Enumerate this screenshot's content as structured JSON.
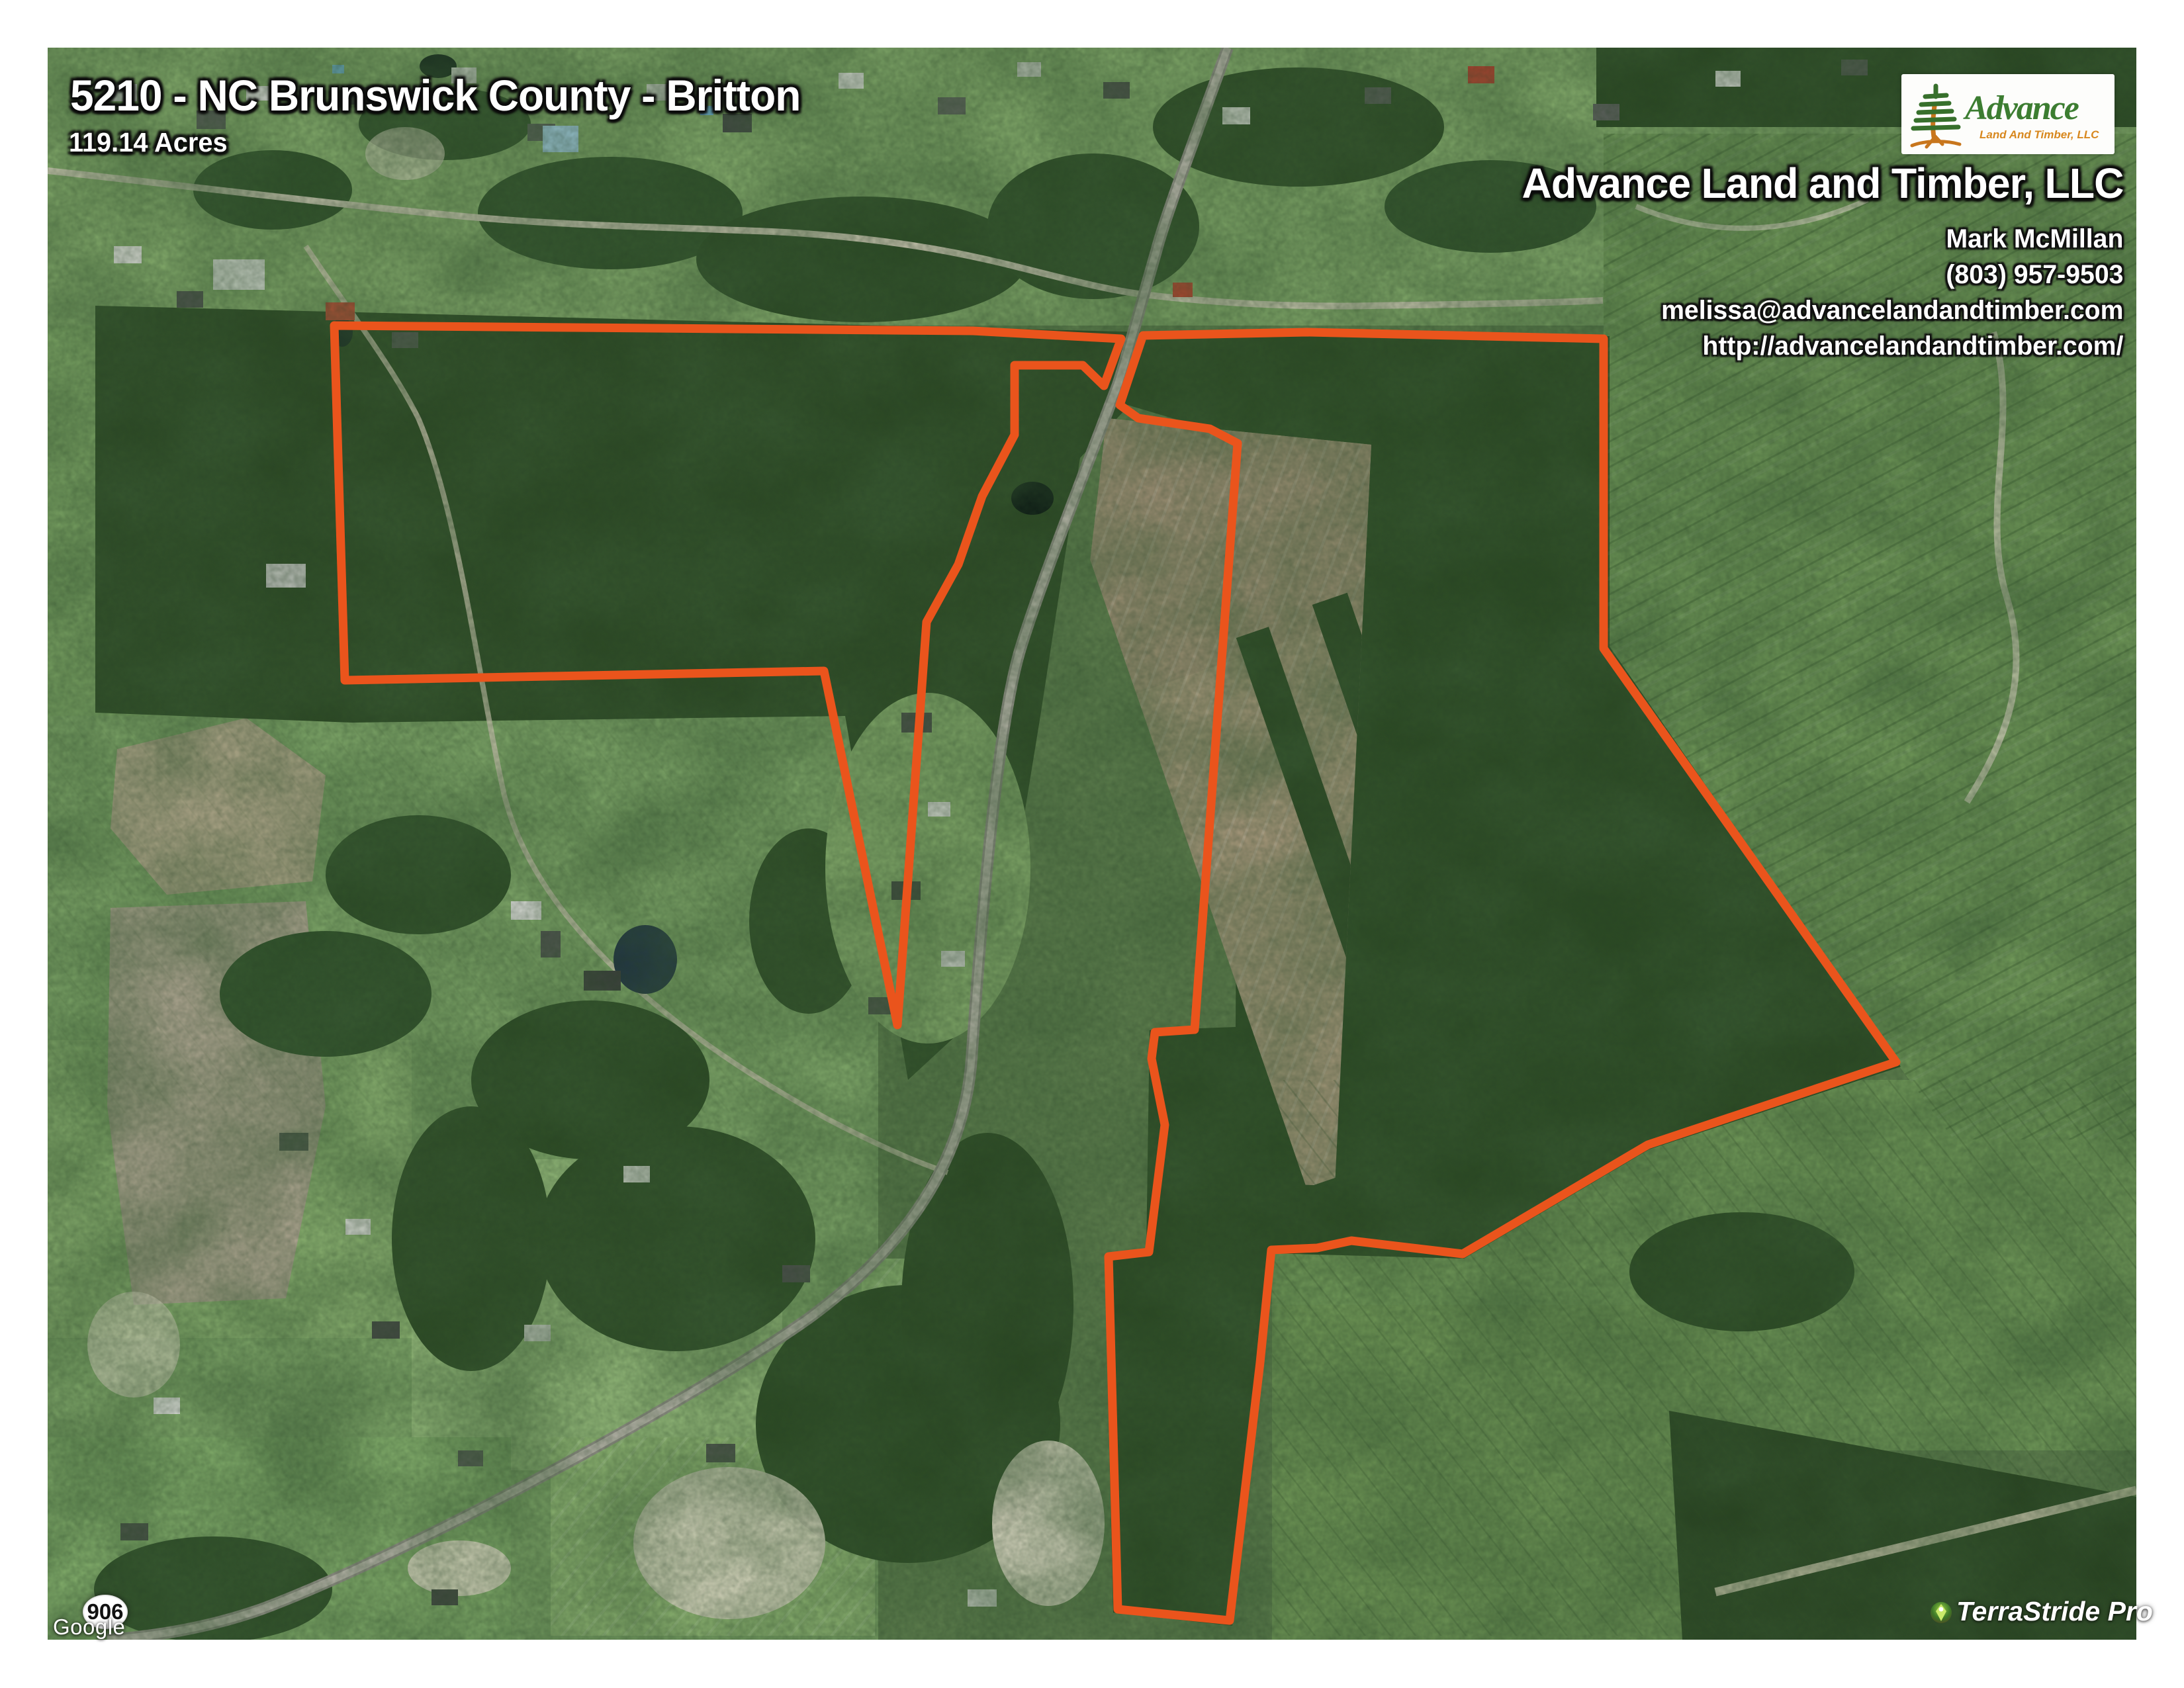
{
  "header": {
    "title": "5210 - NC Brunswick County - Britton",
    "acres": "119.14 Acres"
  },
  "branding": {
    "logo_name": "Advance",
    "logo_subtitle": "Land And Timber, LLC",
    "company": "Advance Land and Timber, LLC",
    "agent": "Mark McMillan",
    "phone": "(803) 957-9503",
    "email": "melissa@advancelandandtimber.com",
    "website": "http://advancelandandtimber.com/"
  },
  "map": {
    "route_badge": "906",
    "imagery_credit": "Google",
    "watermark": "TerraStride Pro",
    "boundary_color": "#ea541c",
    "boundary": {
      "left_tract": "433,420 1398,428 1622,440 1596,511 1564,480 1461,480 1461,585 1412,678 1376,781 1328,868 1284,1477 1173,942 449,956",
      "right_tract": "1655,435 1903,430 2351,440 2351,908 2793,1533 2418,1658 2138,1823 1970,1803 1918,1814 1849,1817 1832,1987 1786,2377 1617,2360 1603,1827 1664,1820 1688,1628 1668,1528 1673,1488 1733,1484 1798,598 1756,576 1648,560 1620,540"
    }
  }
}
